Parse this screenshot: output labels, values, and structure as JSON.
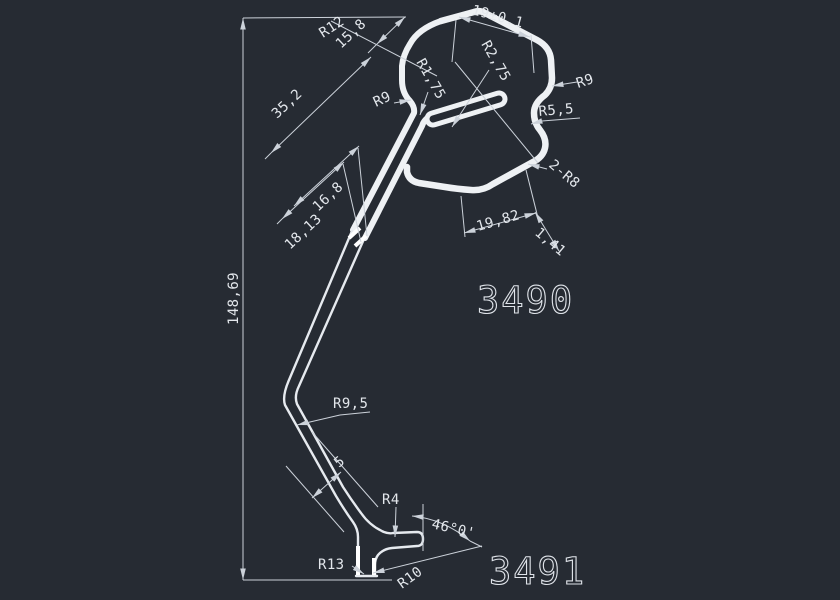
{
  "canvas": {
    "background": "#262b33",
    "line_color": "#eef1f4",
    "dim_line_color": "#ccd2da",
    "highlight_color": "#ffffff"
  },
  "part_numbers": {
    "upper": "3490",
    "lower": "3491"
  },
  "labels": {
    "r12": "R12",
    "d15_8": "15,8",
    "d19tol": "19±0.1",
    "r2_75": "R2,75",
    "r1_75": "R1,75",
    "r9_left": "R9",
    "r9_right": "R9",
    "r5_5": "R5,5",
    "r8x2": "2-R8",
    "d35_2": "35,2",
    "d16_8": "16,8",
    "d18_13": "18,13",
    "d148_69": "148,69",
    "d19_82": "19,82",
    "d1_41": "1,41",
    "r9_5": "R9,5",
    "d5": "5",
    "r4": "R4",
    "angle46": "46°0'",
    "r13": "R13",
    "r10": "R10"
  }
}
